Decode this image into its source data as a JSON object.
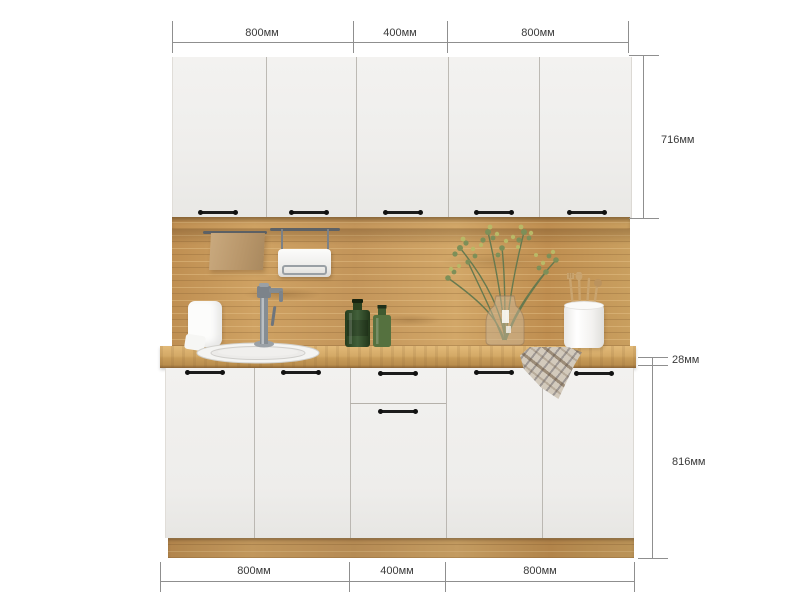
{
  "description": "Kitchen cabinet set front view with dimension annotations",
  "dims": {
    "top": [
      "800мм",
      "400мм",
      "800мм"
    ],
    "bottom": [
      "800мм",
      "400мм",
      "800мм"
    ],
    "right_upper": "716мм",
    "right_counter": "28мм",
    "right_base": "816мм"
  },
  "dimensions_mm": {
    "section_widths": [
      800,
      400,
      800
    ],
    "upper_cabinet_height": 716,
    "countertop_thickness": 28,
    "base_cabinet_height": 816
  },
  "palette": {
    "background": "#ffffff",
    "door_white": "#f1f0ee",
    "wood_oak": "#c7995c",
    "handle_black": "#1c1c1c",
    "dimension_line": "#8f8f8f",
    "dimension_text": "#3a3a3a",
    "bottle_green": "#3c5a30",
    "foliage_green": "#7d8f58"
  },
  "objects": [
    "upper-cabinets-five-doors",
    "wood-backsplash-panel",
    "rail-with-kraft-towel",
    "rail-with-dispenser-box",
    "paper-towel-holder",
    "chrome-faucet",
    "round-inset-sink",
    "green-glass-bottles",
    "glass-vase-with-greenery",
    "utensil-cup-with-wooden-tools",
    "plaid-kitchen-towel",
    "wood-countertop",
    "base-cabinets-with-drawer",
    "wood-plinth"
  ]
}
